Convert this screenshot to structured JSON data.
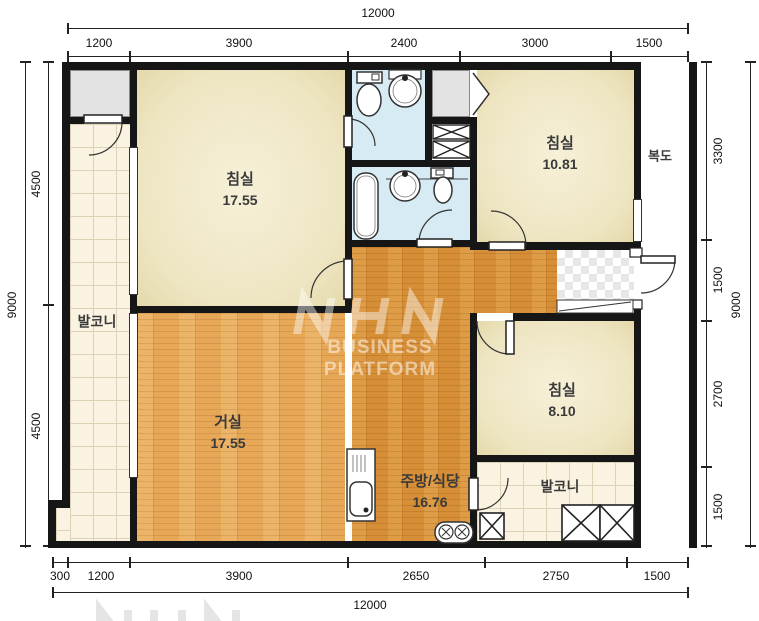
{
  "plan": {
    "rooms": {
      "bedroom_top_left": {
        "name": "침실",
        "area": "17.55"
      },
      "bedroom_top_right": {
        "name": "침실",
        "area": "10.81"
      },
      "bedroom_bottom_right": {
        "name": "침실",
        "area": "8.10"
      },
      "living_room": {
        "name": "거실",
        "area": "17.55"
      },
      "kitchen_dining": {
        "name": "주방/식당",
        "area": "16.76"
      },
      "balcony_left": {
        "name": "발코니"
      },
      "balcony_bottom_right": {
        "name": "발코니"
      },
      "corridor": {
        "name": "복도"
      }
    },
    "watermark": {
      "logo": "NHN",
      "text": "BUSINESS PLATFORM"
    }
  },
  "dimensions": {
    "top": {
      "total": "12000",
      "segments": [
        "1200",
        "3900",
        "2400",
        "3000",
        "1500"
      ]
    },
    "bottom": {
      "total": "12000",
      "segments": [
        "300",
        "1200",
        "3900",
        "2650",
        "2750",
        "1500"
      ]
    },
    "left": {
      "total": "9000",
      "segments": [
        "4500",
        "4500"
      ]
    },
    "right": {
      "total": "9000",
      "segments": [
        "3300",
        "1500",
        "2700",
        "1500"
      ]
    }
  },
  "colors": {
    "wall": "#161616",
    "bedroom_fill": "#eee5c2",
    "wood_light": "#e6a756",
    "wood_dark": "#d68f36",
    "bath_fill": "#d6ebf3",
    "tile_fill": "#faf3e1",
    "gray_fill": "#e3e3e3"
  }
}
